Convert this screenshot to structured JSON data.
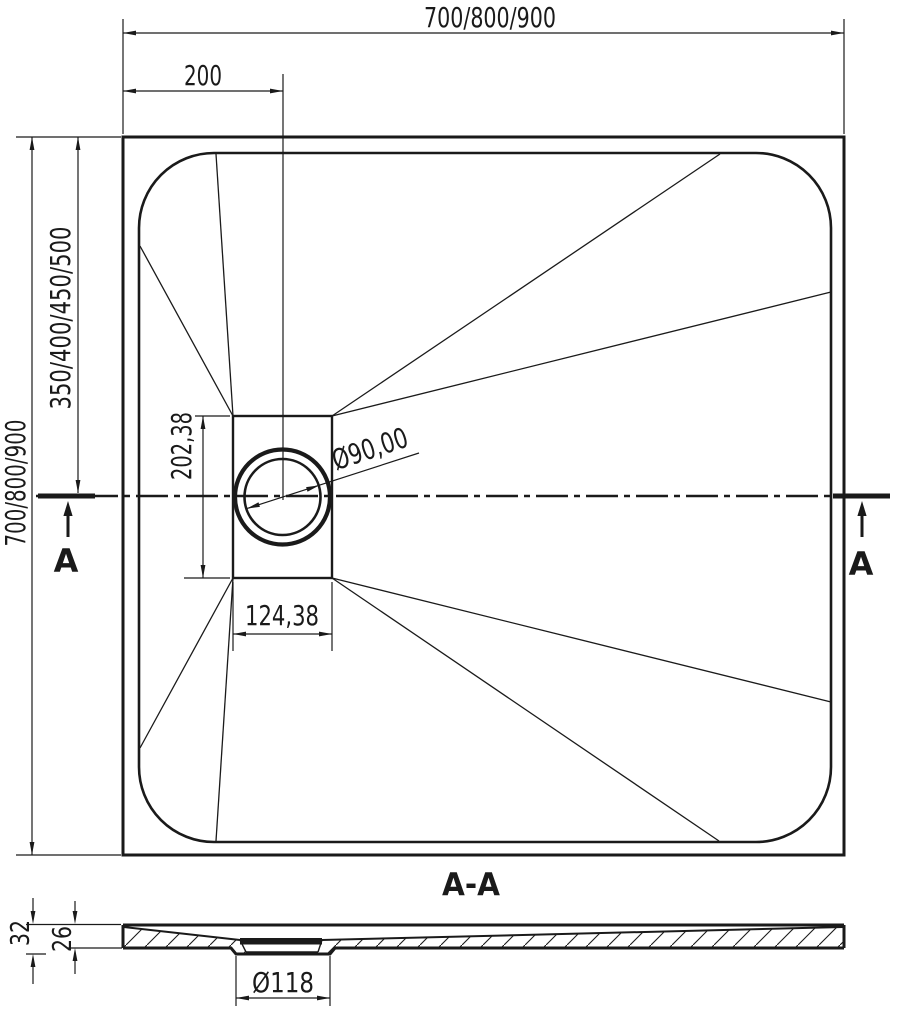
{
  "drawing": {
    "plan": {
      "dim_overall_width": "700/800/900",
      "dim_drain_offset": "200",
      "dim_overall_height": "700/800/900",
      "dim_center_height": "350/400/450/500",
      "dim_drain_box_height": "202,38",
      "dim_drain_box_width": "124,38",
      "dim_drain_diameter": "Ø90,00",
      "cut_marker_left": "A",
      "cut_marker_right": "A"
    },
    "section": {
      "title": "A-A",
      "dim_total_height": "32",
      "dim_body_height": "26",
      "dim_waste_diameter": "Ø118"
    },
    "colors": {
      "ink": "#1a1a1a",
      "background": "#ffffff"
    }
  }
}
